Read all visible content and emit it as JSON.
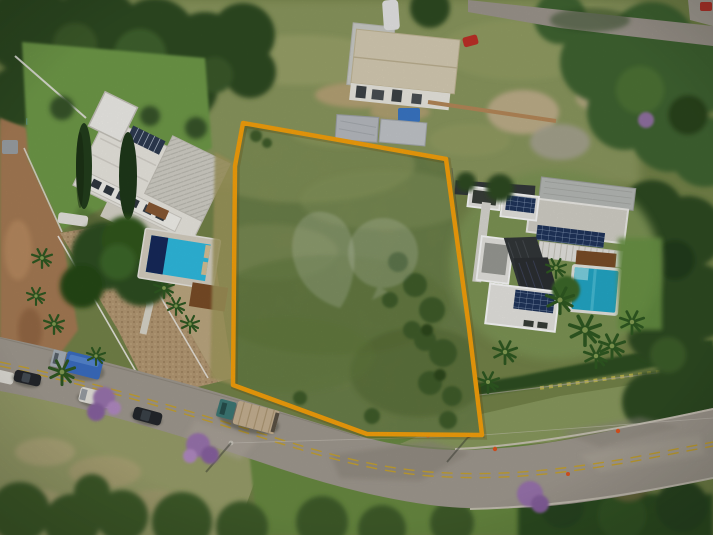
{
  "scene": {
    "type": "aerial-drone-photograph",
    "description": "Vacant grassy land plot outlined in orange, flanked by a white villa with pool (left), a modern solar-panel house with pool (right), a building under construction (top) and a curved street with vehicles (bottom)",
    "objects": [
      "land-plot-boundary",
      "vacant-lot-grass",
      "left-villa",
      "left-pool",
      "right-house-solar",
      "right-pool",
      "construction-building",
      "street",
      "truck-blue-tarp",
      "teal-truck",
      "white-van",
      "dark-cars",
      "purple-flowering-trees",
      "palm-trees",
      "watermark-logo"
    ]
  },
  "boundary": {
    "color": "#F9A30C",
    "stroke_width": "4.5"
  },
  "watermark": {
    "color": "#ffffff",
    "opacity": "0.17"
  },
  "colors": {
    "grass_base": "#75854A",
    "field_top": "#8C995E",
    "lawn": "#6F9B4A",
    "lawn_right": "#6A9444",
    "trees_dark": "#2E4B22",
    "trees_mid": "#3F6530",
    "scrub": "#3F5D2B",
    "dry_grass": "#9AA06B",
    "green_band": "#6A8C43",
    "hedge": "#2F4F23",
    "dirt": "#A87B54",
    "dirt_light": "#C2A77C",
    "road": "#A29B91",
    "road_dark": "#8E877D",
    "lane_yellow": "#C8A432",
    "cobble": "#B69A74",
    "patio": "#C3AC85",
    "house_white": "#EDEBE4",
    "roof_beige": "#D9CFB6",
    "metal_roof": "#BCC0C3",
    "roof_concrete": "#D5D3CA",
    "solar_panel": "#20355C",
    "panel_dark": "#34383B",
    "pool_left": "#2FBEE3",
    "pool_lane": "#172A5C",
    "pool_right": "#23A9C9",
    "deck_wood": "#7C4E28",
    "tarp_blue": "#3B6FC4",
    "truck_teal": "#3E7A76",
    "cargo_beige": "#C8B394",
    "vehicle_dark": "#24272C",
    "vehicle_white": "#E8E6DF",
    "bloom_purple": "#9B74B0",
    "fence_white": "#EDEBE5",
    "cone_orange": "#E05520"
  }
}
